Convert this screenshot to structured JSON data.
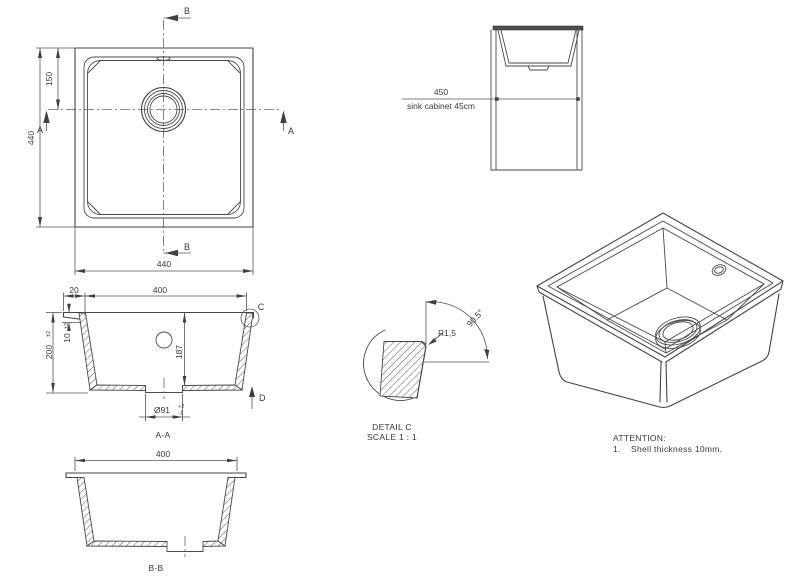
{
  "colors": {
    "line": "#454545",
    "text": "#3a3a3a",
    "countertop_fill": "#4d4d4d",
    "background": "#ffffff"
  },
  "top_view": {
    "dim_height": "440",
    "dim_drain_offset": "150",
    "dim_width": "440",
    "marker_a": "A",
    "marker_b": "B"
  },
  "cabinet_view": {
    "dim_width": "450",
    "label": "sink cabinet 45cm"
  },
  "section_aa": {
    "dim_rim": "20",
    "dim_opening": "400",
    "dim_height": "200",
    "dim_height_tol": "±2",
    "dim_flange": "10",
    "dim_flange_tol": "±2",
    "dim_depth": "187",
    "dim_drain": "Ø91",
    "dim_drain_tol_plus": "+2",
    "dim_drain_tol_minus": "-1",
    "detail_label": "C",
    "arrow_label": "D",
    "title": "A-A"
  },
  "detail_c": {
    "radius": "R1,5",
    "angle": "90.5°",
    "title": "DETAIL C",
    "scale": "SCALE 1 : 1"
  },
  "section_bb": {
    "dim_opening": "400",
    "title": "B-B"
  },
  "attention": {
    "heading": "ATTENTION:",
    "item_number": "1.",
    "item_text": "Shell thickness 10mm."
  }
}
